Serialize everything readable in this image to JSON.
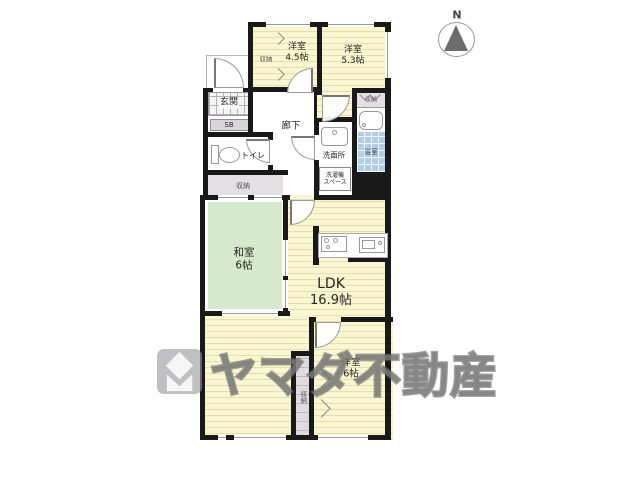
{
  "compass": {
    "label": "N"
  },
  "rooms": {
    "yoshitsu45": {
      "name": "洋室",
      "size": "4.5帖"
    },
    "yoshitsu53": {
      "name": "洋室",
      "size": "5.3帖"
    },
    "washitsu": {
      "name": "和室",
      "size": "6帖"
    },
    "ldk": {
      "name": "LDK",
      "size": "16.9帖"
    },
    "yoshitsu6": {
      "name": "洋室",
      "size": "6帖"
    },
    "genkan": {
      "name": "玄関"
    },
    "shoebox": {
      "name": "SB"
    },
    "corridor": {
      "name": "廊下"
    },
    "toilet": {
      "name": "トイレ"
    },
    "washroom": {
      "name": "洗面所"
    },
    "washer_space": {
      "line1": "洗濯機",
      "line2": "スペース"
    },
    "bathroom": {
      "name": "浴室"
    },
    "closet": {
      "name": "収納"
    }
  },
  "watermark": {
    "text": "ヤマダ不動産"
  },
  "colors": {
    "wall": "#191919",
    "floor_yellow": "#FAF6D1",
    "tatami_green": "#D7E9CD",
    "bath_blue": "#B2CEE7",
    "closet_gray": "#E3DFE3",
    "watermark_gray": "#9b9b9b"
  }
}
